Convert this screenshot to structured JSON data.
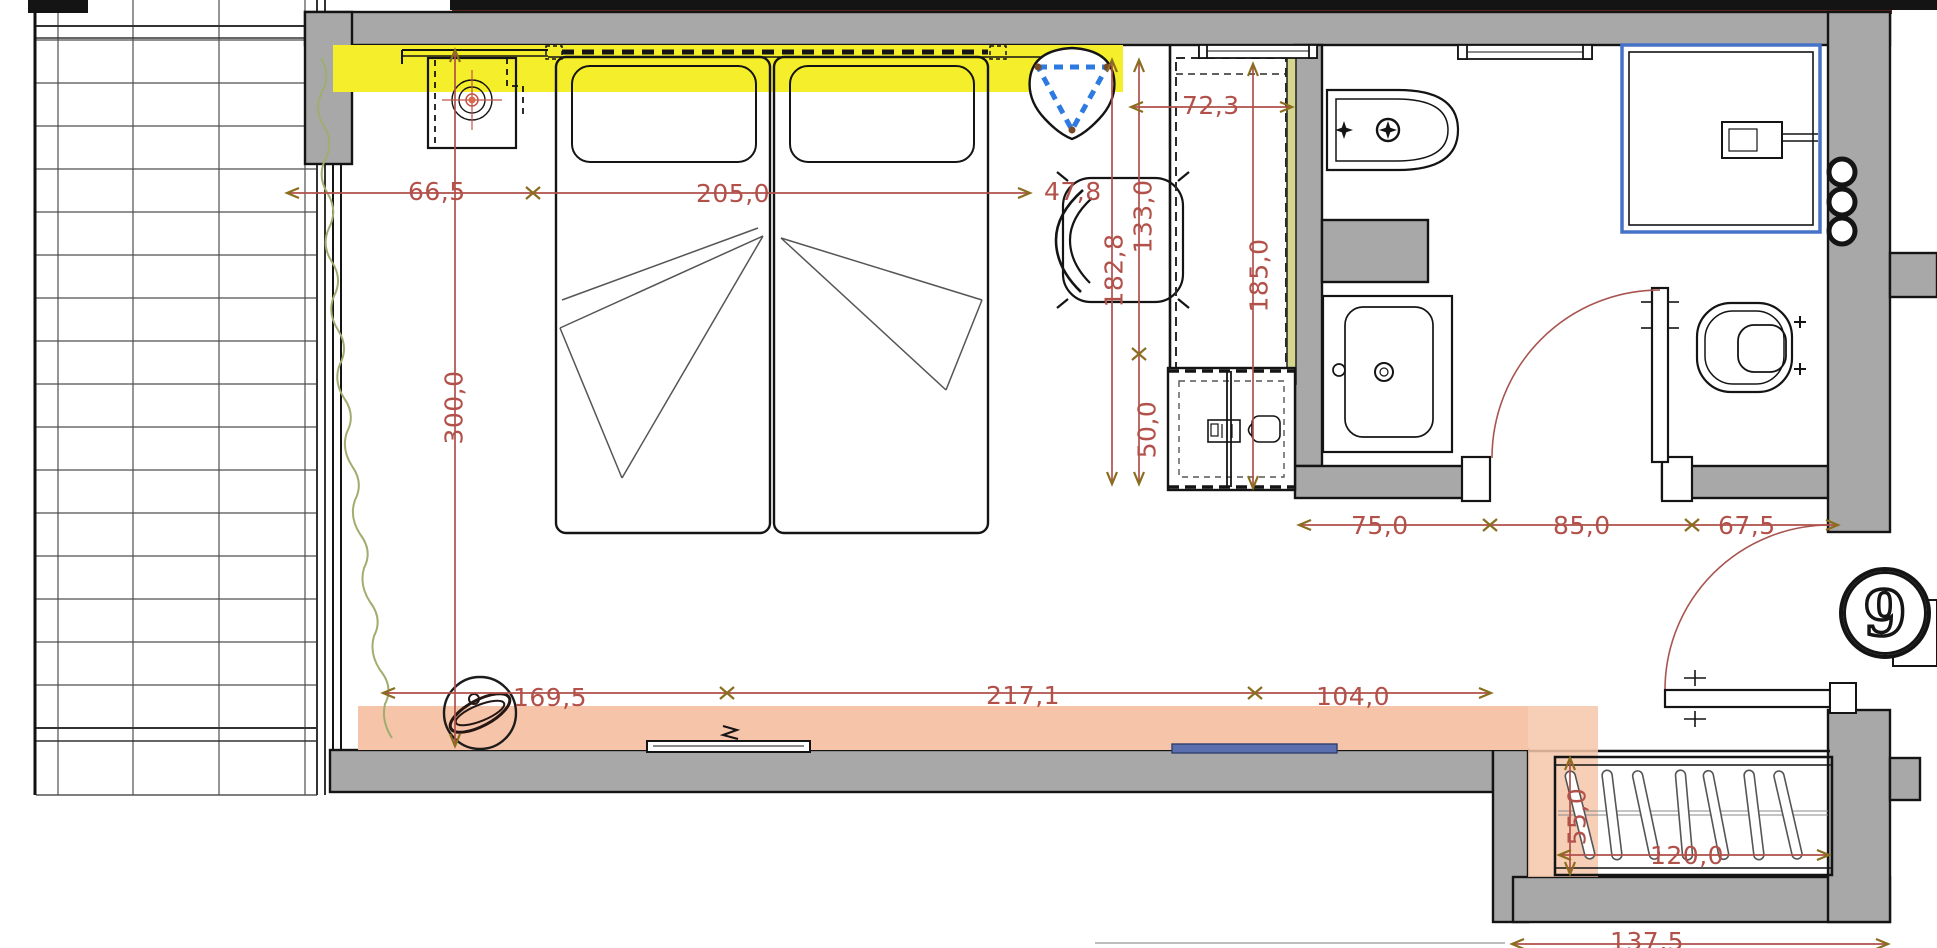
{
  "floorplan": {
    "room_number": "9",
    "dims": {
      "wall_to_bed": "66,5",
      "beds_width": "205,0",
      "bed_to_alcove": "47,8",
      "room_depth": "300,0",
      "alcove_width": "72,3",
      "alcove_upper": "133,0",
      "alcove_total": "182,8",
      "alcove_full_depth": "185,0",
      "minibar_depth": "50,0",
      "window_wall_a": "169,5",
      "window_wall_b": "217,1",
      "window_wall_c": "104,0",
      "bath_zone_sink": "75,0",
      "bath_zone_door": "85,0",
      "bath_zone_toilet": "67,5",
      "closet_depth": "55,0",
      "closet_width": "120,0",
      "entry_wall": "137,5"
    },
    "colors": {
      "wall_gray": "#a8a8a8",
      "highlight_yellow": "#f4ef2a",
      "highlight_orange": "#f6c5a9",
      "dimension_red": "#b2504a",
      "arrow_amber": "#8a6d1f",
      "shower_blue": "#4673c8",
      "triangle_blue": "#2d7ae0",
      "radiator_blue": "#5b6fae",
      "curtain_green": "#9fae6f",
      "mirror_green": "#d6d78c"
    },
    "furniture_icons": [
      "twin-beds-icon",
      "pillow-icon",
      "nightstand-icon",
      "table-lamp-icon",
      "hanging-chair-icon",
      "armchair-icon",
      "wardrobe-dashed-icon",
      "mirror-icon",
      "minibar-safe-icon",
      "bidet-icon",
      "washbasin-icon",
      "toilet-icon",
      "shower-enclosure-icon",
      "towel-rail-icon",
      "towel-rings-icon",
      "door-swing-icon",
      "entrance-door-icon",
      "hanger-closet-icon",
      "sphere-chair-icon",
      "tv-console-icon",
      "curtain-icon",
      "radiator-icon",
      "balcony-tiles-icon"
    ]
  }
}
